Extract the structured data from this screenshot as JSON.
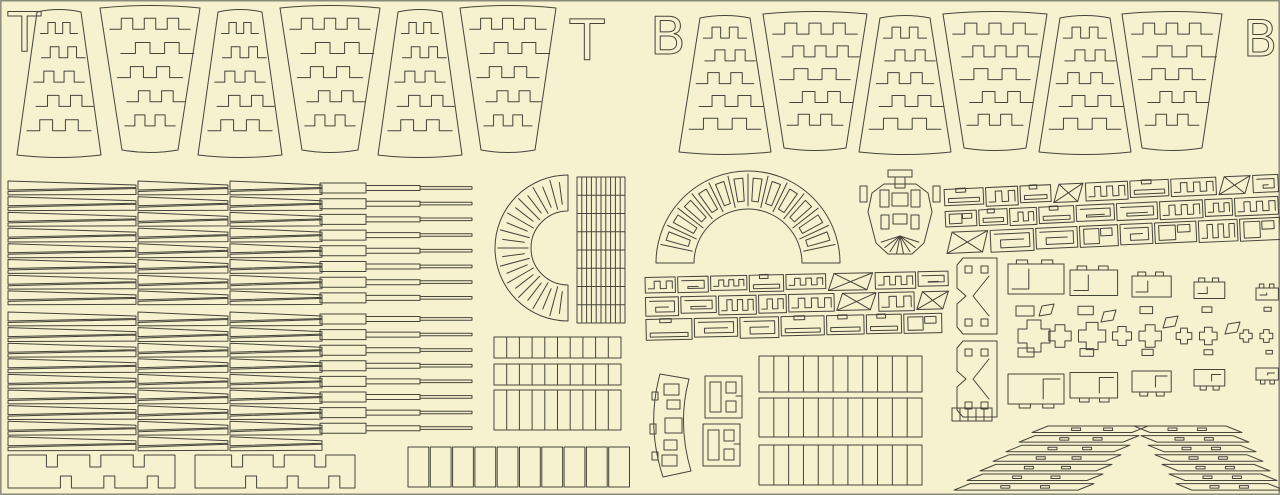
{
  "labels": {
    "sheet_t_left": "T",
    "sheet_t_right": "T",
    "sheet_b_left": "B",
    "sheet_b_right": "B"
  },
  "colors": {
    "background": "#F6F2CF",
    "line": "#45453A",
    "border": "#8A8A7A"
  },
  "parts": [
    "gore-panel-top-sheet",
    "gore-panel-bottom-sheet",
    "tapered-plank-strip",
    "stepped-batten-strip",
    "c-ring-maze-piece",
    "ladder-grid-panel",
    "fan-arch-piece",
    "hub-cap-piece",
    "puzzle-piece-band",
    "puzzle-piece-cluster",
    "notched-joiner-bar",
    "cell-strip",
    "curved-slat-piece",
    "bracket-square-piece",
    "diagonal-slat-stack"
  ]
}
